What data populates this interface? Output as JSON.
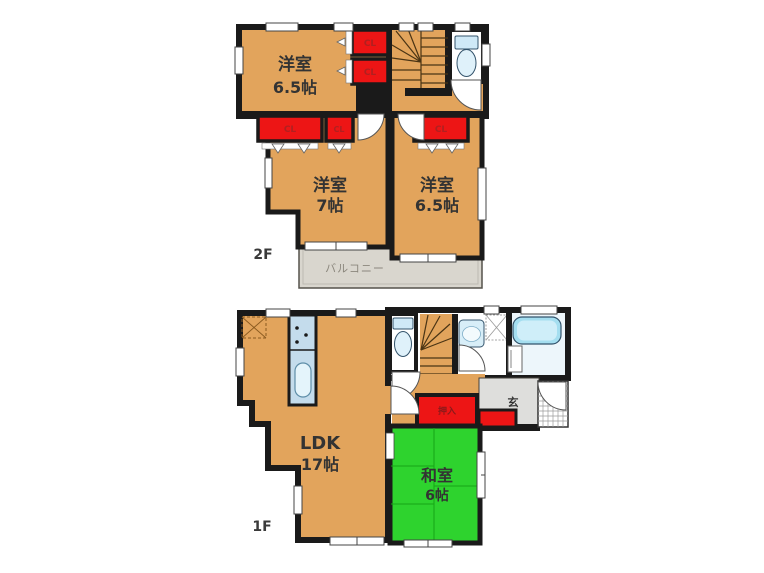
{
  "colors": {
    "room": "#E2A45C",
    "tatami": "#2ED32E",
    "closet": "#ED1515",
    "wall": "#1A1A1A",
    "balcony": "#D9D6CE",
    "entrance": "#DEDEDC",
    "fixture_blue": "#CFE9F7",
    "tub": "#A4DEF0"
  },
  "floor2": {
    "floor_label": "2F",
    "room_top": {
      "name": "洋室",
      "size": "6.5帖"
    },
    "room_left": {
      "name": "洋室",
      "size": "7帖"
    },
    "room_right": {
      "name": "洋室",
      "size": "6.5帖"
    },
    "balcony_label": "バルコニー",
    "closet_label": "CL"
  },
  "floor1": {
    "floor_label": "1F",
    "ldk": {
      "name": "LDK",
      "size": "17帖"
    },
    "washitsu": {
      "name": "和室",
      "size": "6帖"
    },
    "entrance_label": "玄",
    "closet_label": "押入"
  }
}
